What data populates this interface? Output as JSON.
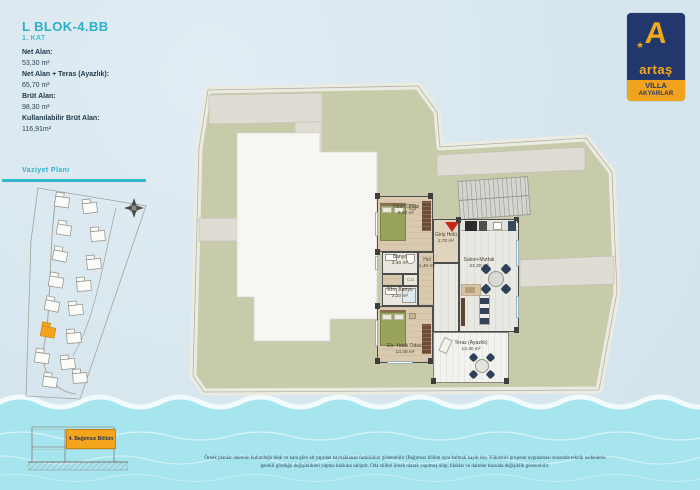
{
  "header": {
    "title": "L BLOK-4.BB",
    "floor": "1. KAT"
  },
  "stats": [
    {
      "label": "Net Alan:",
      "value": "53,30 m²"
    },
    {
      "label": "Net Alan + Teras (Ayazlık):",
      "value": "65,70 m²"
    },
    {
      "label": "Brüt Alan:",
      "value": "98,30 m²"
    },
    {
      "label": "Kullanılabilir Brüt Alan:",
      "value": "116,91m²"
    }
  ],
  "logo": {
    "letter": "A",
    "star": "★",
    "brand": "artaş",
    "tagline1": "VİLLA",
    "tagline2": "AKYARLAR"
  },
  "site_plan": {
    "title": "Vaziyet Planı"
  },
  "floor_plan": {
    "rooms": [
      {
        "name": "Yatak Odası",
        "area": "9,60 m²"
      },
      {
        "name": "Banyo",
        "area": "3,40 m²"
      },
      {
        "name": "Hol",
        "area": "1,40 m²"
      },
      {
        "name": "Ebv. Banyo",
        "area": "2,20 m²"
      },
      {
        "name": "Eb. Yatak Odası",
        "area": "13,30 m²"
      },
      {
        "name": "Giriş Holü",
        "area": "2,70 m²"
      },
      {
        "name": "Salon+Mutfak",
        "area": "22,20 m²"
      },
      {
        "name": "Teras (Ayazlık)",
        "area": "12,40 m²"
      },
      {
        "name": "C.D.",
        "area": ""
      }
    ]
  },
  "section_legend": {
    "label": "4. Bağımsız Bölüm"
  },
  "disclaimer": {
    "line1": "Örnek planlar dairenin bulunduğu blok ve kata göre alt yapıdan kaynaklanan farklılıklar gösterebilir (Bağımsız bölüm aynı kalmak kaydı ile). Yüklenici projenin uygulaması sırasında teknik nedenlerle",
    "line2": "gerekli gördüğü değişiklikleri yapma hakkına sahiptir. Oda stilleri örnek olarak yapılmış olup, bloklar ve daireler bazında değişiklik gösterebilir."
  },
  "colors": {
    "accent_teal": "#29b1c7",
    "brand_navy": "#22376b",
    "brand_yellow": "#f3a81a",
    "highlight_orange": "#f5a41e",
    "water_cyan": "#a6e5ee",
    "site_green": "#c7cbaa"
  }
}
